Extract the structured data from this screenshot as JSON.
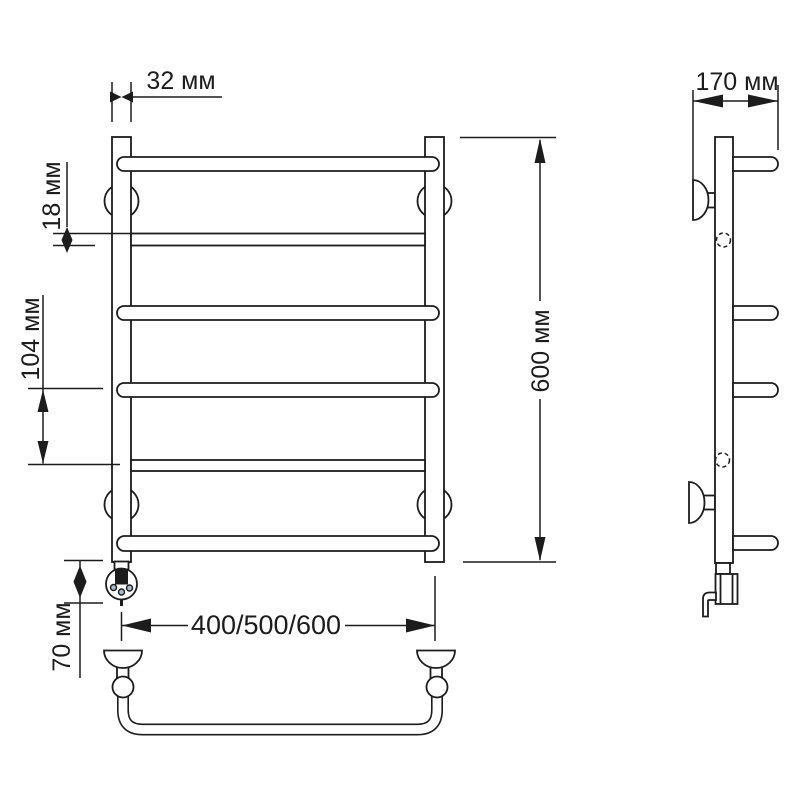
{
  "diagram": {
    "type": "technical-dimension-drawing",
    "subject": "ladder towel rail with electric heating element, front and side views",
    "units": "мм",
    "colors": {
      "line": "#1c1c1c",
      "bg": "#ffffff",
      "dot": "#a9bcc9"
    },
    "labels": {
      "post_width": "32 мм",
      "tube_diameter": "18 мм",
      "rung_spacing": "104 мм",
      "heater_height": "70 мм",
      "height": "600 мм",
      "depth": "170 мм",
      "width_options": "400/500/600"
    }
  }
}
